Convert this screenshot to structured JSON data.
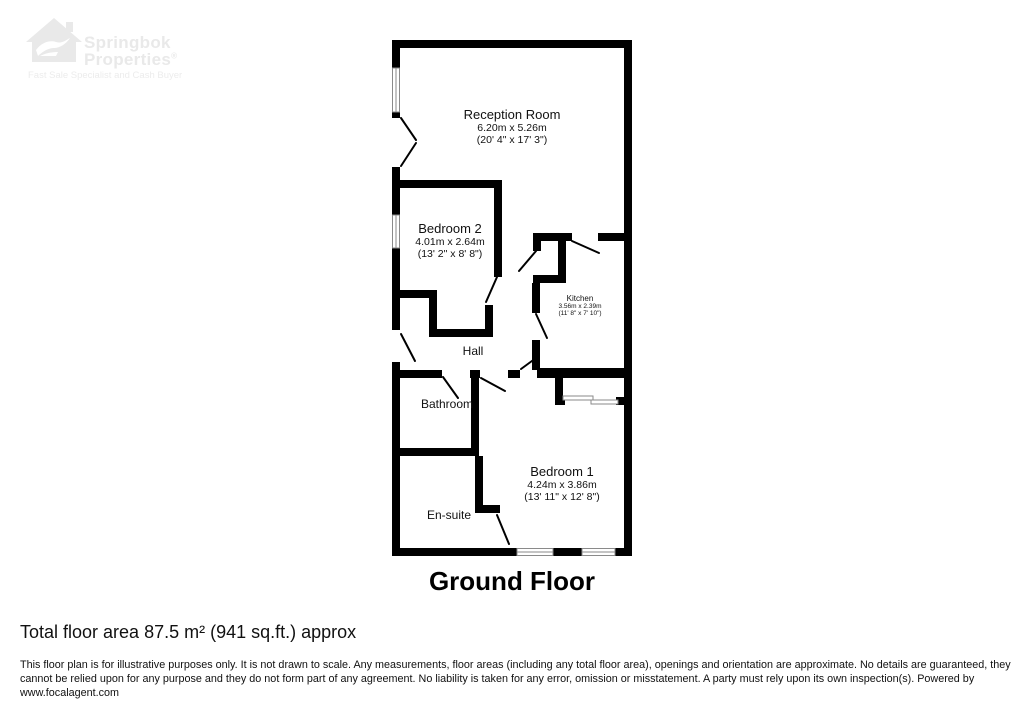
{
  "logo": {
    "icon": "springbok-house-icon",
    "name": "Springbok",
    "name2": "Properties",
    "registered": "®",
    "tagline": "Fast Sale Specialist and Cash Buyer",
    "color": "#e9e9e9"
  },
  "floorplan": {
    "title": "Ground Floor",
    "wall_color": "#000000",
    "rooms": [
      {
        "id": "reception",
        "name": "Reception Room",
        "metric": "6.20m x 5.26m",
        "imperial": "(20' 4\" x 17' 3\")"
      },
      {
        "id": "bedroom2",
        "name": "Bedroom 2",
        "metric": "4.01m x 2.64m",
        "imperial": "(13' 2\" x 8' 8\")"
      },
      {
        "id": "kitchen",
        "name": "Kitchen",
        "metric": "3.56m x 2.39m",
        "imperial": "(11' 8\" x 7' 10\")"
      },
      {
        "id": "hall",
        "name": "Hall"
      },
      {
        "id": "bathroom",
        "name": "Bathroom"
      },
      {
        "id": "ensuite",
        "name": "En-suite"
      },
      {
        "id": "bedroom1",
        "name": "Bedroom 1",
        "metric": "4.24m x 3.86m",
        "imperial": "(13' 11\" x 12' 8\")"
      }
    ]
  },
  "footer": {
    "total_area": "Total floor area 87.5 m² (941 sq.ft.) approx",
    "disclaimer": "This floor plan is for illustrative purposes only. It is not drawn to scale. Any measurements, floor areas (including any total floor area), openings and orientation are approximate. No details are guaranteed, they cannot be relied upon for any purpose and they do not form part of any agreement. No liability is taken for any error, omission or misstatement. A party must rely upon its own inspection(s). Powered by www.focalagent.com"
  }
}
